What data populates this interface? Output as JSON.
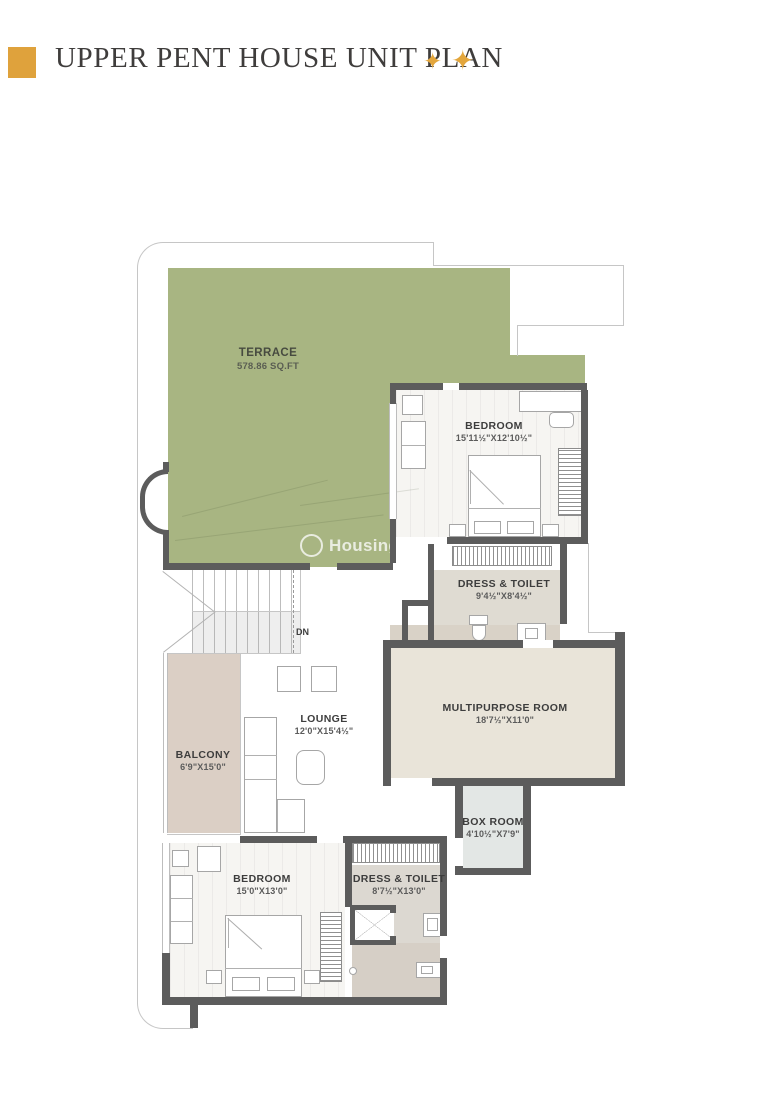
{
  "header": {
    "title": "UPPER PENT HOUSE UNIT PLAN",
    "star": "✦"
  },
  "watermark": {
    "brand": "Housing"
  },
  "stairs": {
    "down_label": "DN"
  },
  "rooms": {
    "terrace": {
      "name": "TERRACE",
      "dims": "578.86 SQ.FT"
    },
    "bedroom_top": {
      "name": "BEDROOM",
      "dims": "15'11½\"X12'10½\""
    },
    "dress_toilet_top": {
      "name": "DRESS & TOILET",
      "dims": "9'4½\"X8'4½\""
    },
    "multipurpose": {
      "name": "MULTIPURPOSE ROOM",
      "dims": "18'7½\"X11'0\""
    },
    "lounge": {
      "name": "LOUNGE",
      "dims": "12'0\"X15'4½\""
    },
    "balcony": {
      "name": "BALCONY",
      "dims": "6'9\"X15'0\""
    },
    "bedroom_bottom": {
      "name": "BEDROOM",
      "dims": "15'0\"X13'0\""
    },
    "dress_toilet_bottom": {
      "name": "DRESS & TOILET",
      "dims": "8'7½\"X13'0\""
    },
    "box_room": {
      "name": "BOX ROOM",
      "dims": "4'10½\"X7'9\""
    }
  },
  "colors": {
    "accent_gold": "#dfa23c",
    "terrace_green": "#a8b582",
    "wall_dark": "#5c5c5c",
    "balcony_floor": "#dbcfc5",
    "multipurpose_floor": "#e9e4d9",
    "box_room_floor": "#e3e7e5",
    "toilet_floor_gray": "#dcd8d1",
    "toilet_floor_beige": "#d6cfc6"
  }
}
